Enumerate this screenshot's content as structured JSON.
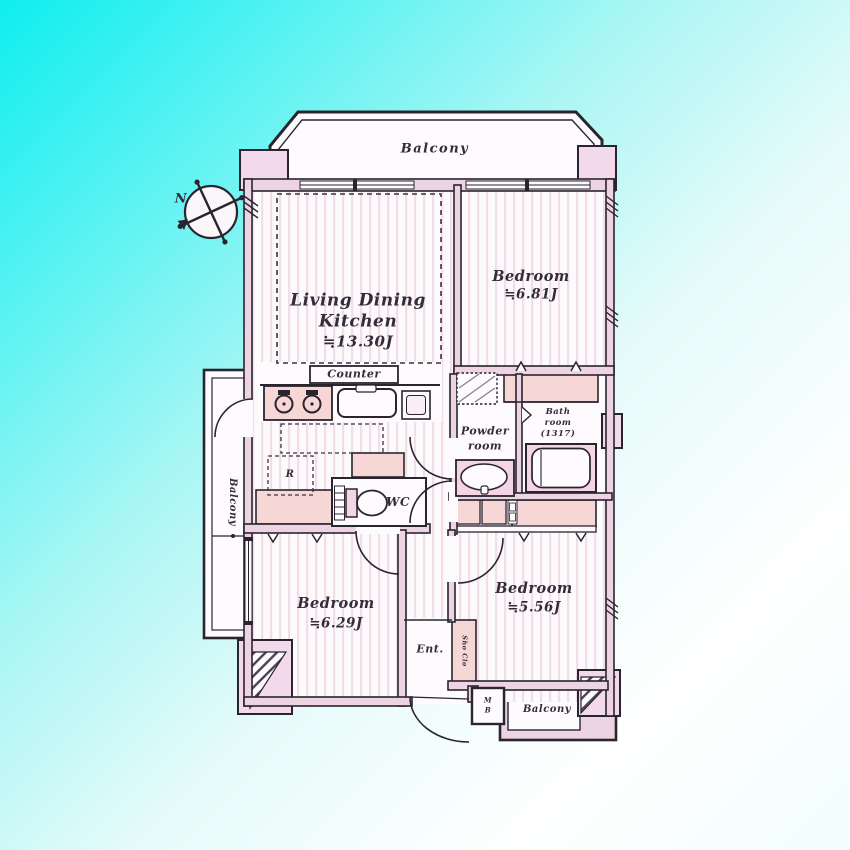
{
  "title": "apartment-floor-plan",
  "colors": {
    "background_cyan": "#0eeeee",
    "background_fade": "#ffffff",
    "wall_fill": "#ecd4e3",
    "pillar_fill": "#f3d9ec",
    "closet_fill": "#f7d7d6",
    "fixture_pink": "#f4d5e6",
    "floor_white": "#fdfafc",
    "floor_stripe": "#f1dee9",
    "line": "#29242e"
  },
  "compass": {
    "north_label": "N"
  },
  "rooms": {
    "balcony_top": {
      "label": "Balcony"
    },
    "balcony_left": {
      "label": "Balcony"
    },
    "balcony_bottom_right": {
      "label": "Balcony"
    },
    "living_dining_kitchen": {
      "name_line1": "Living Dining",
      "name_line2": "Kitchen",
      "area": "≒13.30J"
    },
    "bedroom_top_right": {
      "name": "Bedroom",
      "area": "≒6.81J"
    },
    "bedroom_bottom_left": {
      "name": "Bedroom",
      "area": "≒6.29J"
    },
    "bedroom_bottom_right": {
      "name": "Bedroom",
      "area": "≒5.56J"
    },
    "kitchen": {
      "counter_label": "Counter",
      "refrigerator_label": "R"
    },
    "wc": {
      "label": "WC"
    },
    "powder_room": {
      "name_line1": "Powder",
      "name_line2": "room"
    },
    "bath_room": {
      "name_line1": "Bath",
      "name_line2": "room",
      "name_line3": "(1317)"
    },
    "entrance": {
      "label": "Ent.",
      "shoe_closet_label": "Sho Clo",
      "meter_box_line1": "M",
      "meter_box_line2": "B"
    }
  }
}
